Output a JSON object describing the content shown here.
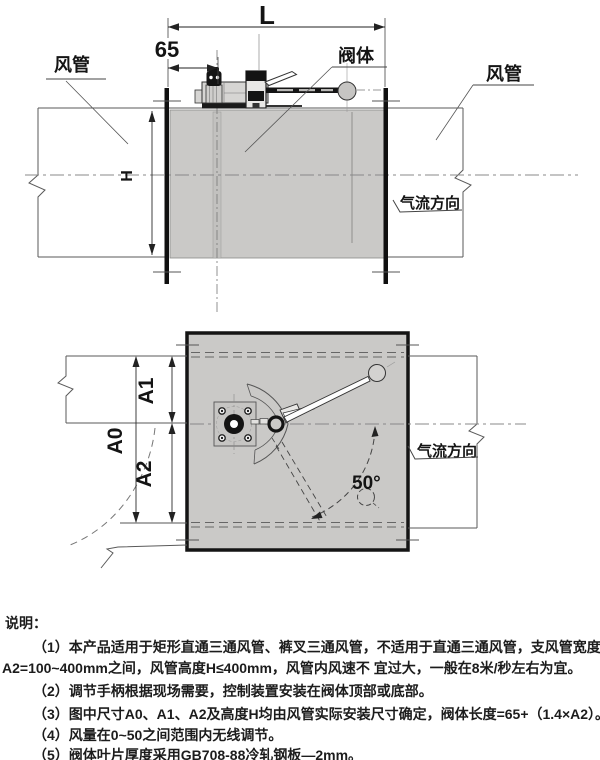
{
  "side_view": {
    "dim_length": "L",
    "dim_offset": "65",
    "dim_height": "H",
    "label_duct_left": "风管",
    "label_valve": "阀体",
    "label_duct_right": "风管",
    "label_airflow": "气流方向"
  },
  "plan_view": {
    "dim_a0": "A0",
    "dim_a1": "A1",
    "dim_a2": "A2",
    "angle": "50°",
    "label_airflow": "气流方向"
  },
  "notes": {
    "title": "说明：",
    "lines": [
      "（1）本产品适用于矩形直通三通风管、裤叉三通风管，不适用于直通三通风管，支风管宽度范围在",
      "A2=100~400mm之间，风管高度H≤400mm，风管内风速不 宜过大，一般在8米/秒左右为宜。",
      "（2）调节手柄根据现场需要，控制装置安装在阀体顶部或底部。",
      "（3）图中尺寸A0、A1、A2及高度H均由风管实际安装尺寸确定，阀体长度=65+（1.4×A2）。",
      "（4）风量在0~50之间范围内无线调节。",
      "（5）阀体叶片厚度采用GB708-88冷轧钢板—2mm。"
    ]
  },
  "colors": {
    "line": "#2b2b2b",
    "duct_fill": "#cac9c7",
    "flange": "#111111",
    "background": "#ffffff"
  }
}
